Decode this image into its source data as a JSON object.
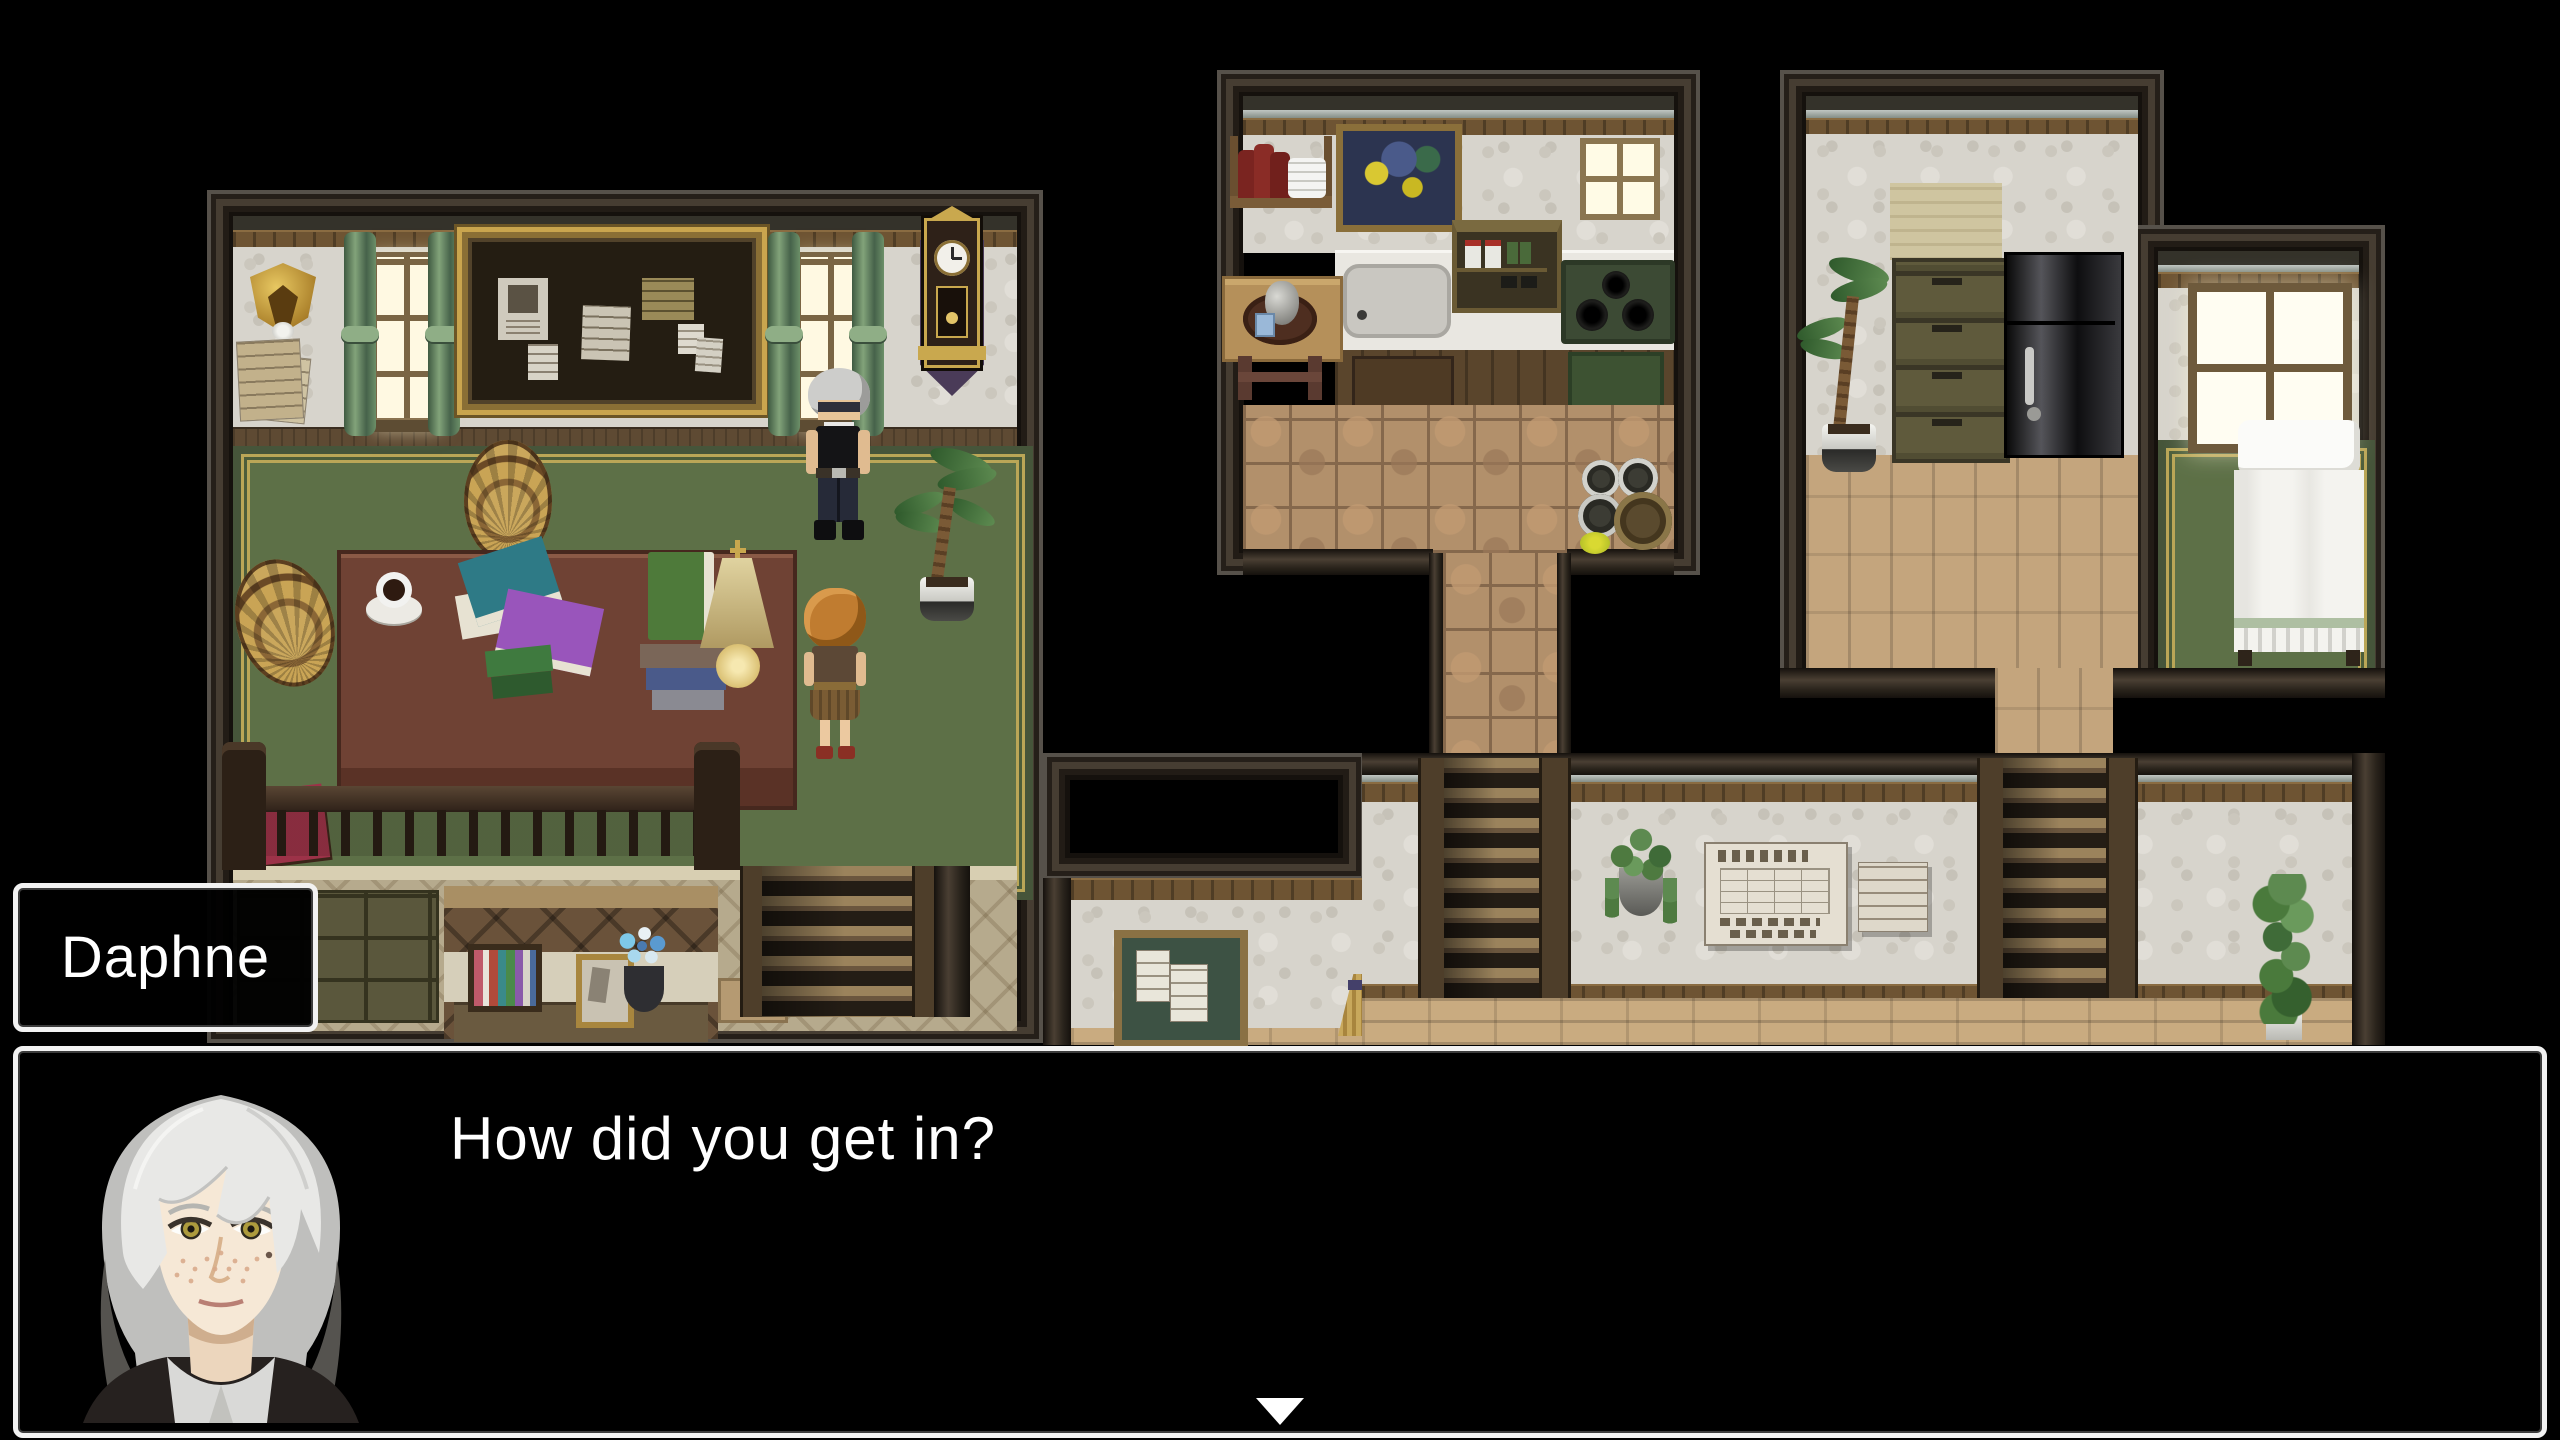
{
  "dialogue": {
    "speaker": "Daphne",
    "message": "How did you get in?"
  },
  "ui": {
    "window_background": "#000000",
    "window_border": "#ffffff",
    "text_color": "#ffffff",
    "continue_indicator": "down-triangle"
  }
}
